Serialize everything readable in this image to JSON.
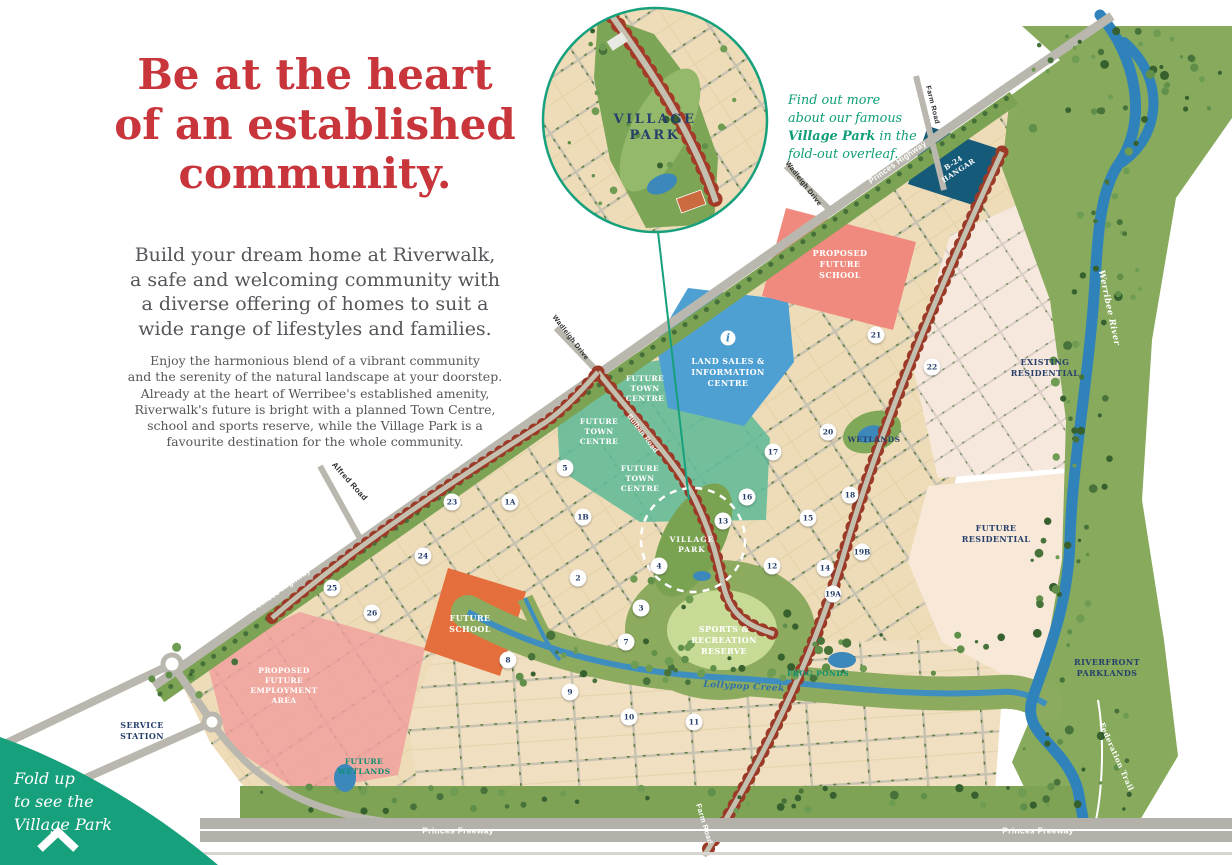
{
  "page": {
    "title_red": "#c8353b",
    "accent_green": "#17a07c"
  },
  "intro": {
    "title": "Be at the heart\nof an established\ncommunity.",
    "lead": "Build your dream home at Riverwalk,\na safe and welcoming community with\na diverse offering of homes to suit a\nwide range of lifestyles and families.",
    "detail": "Enjoy the harmonious blend of a vibrant community\nand the serenity of the natural landscape at your doorstep.\nAlready at the heart of Werribee's established amenity,\nRiverwalk's future is bright with a planned Town Centre,\nschool and sports reserve, while the Village Park is a\nfavourite destination for the whole community."
  },
  "callout": {
    "prefix": "Find out more\nabout our famous\n",
    "bold": "Village Park",
    "suffix": " in the\nfold-out overleaf."
  },
  "inset": {
    "label": "VILLAGE\nPARK"
  },
  "fold_note": {
    "text": "Fold up\nto see the\nVillage Park"
  },
  "map": {
    "zones": {
      "proposed_future_school": "PROPOSED\nFUTURE\nSCHOOL",
      "land_sales": "LAND SALES &\nINFORMATION\nCENTRE",
      "info_icon": "i",
      "future_town_centre": "FUTURE\nTOWN\nCENTRE",
      "b24_hangar": "B-24\nHANGAR",
      "existing_residential": "EXISTING\nRESIDENTIAL",
      "future_residential": "FUTURE\nRESIDENTIAL",
      "wetlands": "WETLANDS",
      "future_school": "FUTURE\nSCHOOL",
      "employment": "PROPOSED\nFUTURE\nEMPLOYMENT\nAREA",
      "sports_reserve": "SPORTS &\nRECREATION\nRESERVE",
      "frog_ponds": "FROG PONDS",
      "riverfront_parklands": "RIVERFRONT\nPARKLANDS",
      "future_wetlands": "FUTURE\nWETLANDS",
      "service_station": "SERVICE\nSTATION",
      "village_park": "VILLAGE\nPARK"
    },
    "roads": {
      "princes_highway": "Princes Highway",
      "princes_freeway": "Princes Freeway",
      "alfred_road": "Alfred Road",
      "farm_road": "Farm Road",
      "wadleigh_drive": "Wadleigh Drive",
      "bulban_road": "Bulban Road"
    },
    "water": {
      "werribee_river": "Werribee River",
      "lollypop_creek": "Lollypop Creek",
      "federation_trail": "Federation Trail"
    },
    "stages": [
      "1A",
      "1B",
      "2",
      "3",
      "4",
      "5",
      "7",
      "8",
      "9",
      "10",
      "11",
      "12",
      "13",
      "14",
      "15",
      "16",
      "17",
      "18",
      "19A",
      "19B",
      "20",
      "21",
      "22",
      "23",
      "24",
      "25",
      "26"
    ]
  }
}
